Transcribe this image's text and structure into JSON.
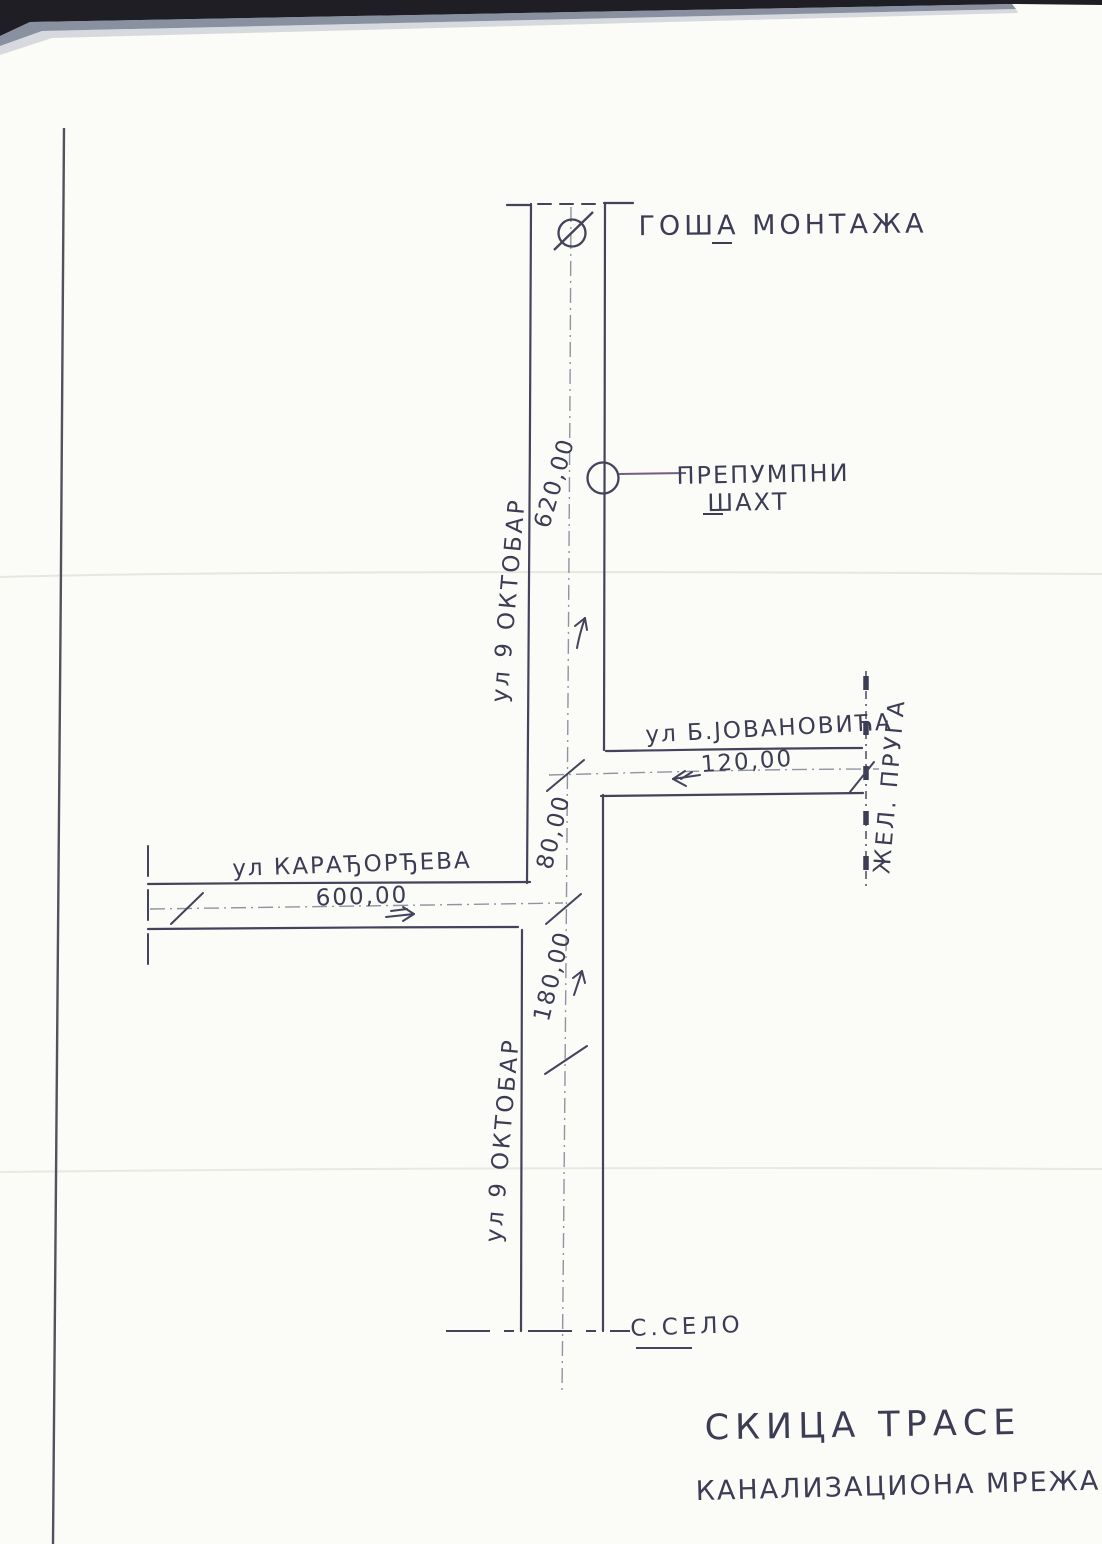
{
  "title": {
    "line1": "СКИЦА ТРАСЕ",
    "line2": "КАНАЛИЗАЦИОНА МРЕЖА"
  },
  "sites": {
    "factory": "ГОША МОНТАЖА",
    "pump_shaft_line1": "ПРЕПУМПНИ",
    "pump_shaft_line2": "ШАХТ",
    "village": "С.СЕЛО"
  },
  "streets": {
    "oktobar": "ул 9 ОКТОБАР",
    "jovanovica": "ул Б.ЈОВАНОВИЋА",
    "karadjordjeva": "ул КАРАЂОРЂЕВА",
    "railway": "ЖЕЛ. ПРУГА"
  },
  "measurements": {
    "oktobar_upper": "620,00",
    "jovanovica": "120,00",
    "karadjordjeva": "600,00",
    "oktobar_mid": "80,00",
    "oktobar_lower": "180,00"
  },
  "colors": {
    "ink": "#3d3d58",
    "centerline": "#8e94a2",
    "leader": "#6f5f85",
    "paper": "#fbfbf7"
  }
}
